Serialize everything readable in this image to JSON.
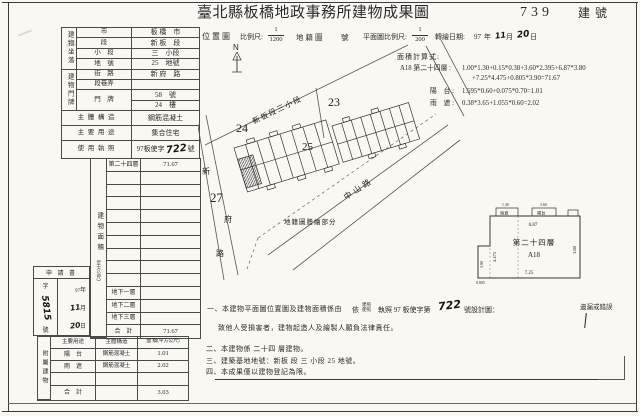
{
  "header": {
    "title": "臺北縣板橋地政事務所建物成果圖",
    "building_no": "739",
    "building_no_suffix": "建號"
  },
  "scalebar": {
    "location_label": "位置圖",
    "scale_label": "比例尺:",
    "loc_num": "1",
    "loc_den": "1200",
    "cadastre": "地籍圖",
    "sheet_suffix": "號",
    "north": "N",
    "plan_scale_label": "平面圖比例尺:",
    "plan_num": "1",
    "plan_den": "200",
    "date_label": "轉繪日期:",
    "date_year": "97",
    "year_char": "年",
    "date_month": "11",
    "month_char": "月",
    "date_day": "20",
    "day_char": "日"
  },
  "calc": {
    "title": "面積計算式:",
    "l1_label": "A18  第二十四層 :",
    "l1a": "1.00*1.30+0.15*0.38+3.60*2.395+6.87*3.80",
    "l1b": "+7.25*4.475+0.805*3.90=71.67",
    "l2_label": "陽　台 :",
    "l2": "1.595*0.60+0.075*0.70=1.01",
    "l3_label": "雨　遮 :",
    "l3": "0.38*3.65+1.055*0.60=2.02"
  },
  "site": {
    "group1_label": "建物坐落",
    "group2_label": "建物門牌",
    "rows": [
      {
        "label": "市",
        "value": "板 橋　市"
      },
      {
        "label": "段",
        "value": "新 板　段"
      },
      {
        "label": "小　段",
        "value": "三　小段"
      },
      {
        "label": "地　號",
        "value": "25　地號"
      },
      {
        "label": "街　路",
        "value": "新 府　路"
      },
      {
        "label": "段巷弄",
        "value": ""
      },
      {
        "label": "門　牌",
        "value": "58　號"
      },
      {
        "label": "",
        "value": "24　樓"
      }
    ],
    "structure_label": "主 體 構 造",
    "structure": "鋼筋混凝土",
    "use_label": "主 要 用 途",
    "use": "集合住宅",
    "license_label": "使 用 執 照",
    "license_pre": "97板使字",
    "license_hw": "722",
    "license_suf": "號"
  },
  "area": {
    "vlabel": "建物面積",
    "unit": "（平方公尺）",
    "rows": [
      {
        "floor": "第二十四層",
        "area": "71.67"
      },
      {
        "floor": "",
        "area": ""
      },
      {
        "floor": "",
        "area": ""
      },
      {
        "floor": "",
        "area": ""
      },
      {
        "floor": "",
        "area": ""
      },
      {
        "floor": "",
        "area": ""
      },
      {
        "floor": "",
        "area": ""
      },
      {
        "floor": "",
        "area": ""
      },
      {
        "floor": "",
        "area": ""
      },
      {
        "floor": "",
        "area": ""
      },
      {
        "floor": "地下一層",
        "area": ""
      },
      {
        "floor": "地下二層",
        "area": ""
      },
      {
        "floor": "地下三層",
        "area": ""
      },
      {
        "floor": "合　計",
        "area": "71.67"
      }
    ]
  },
  "annex": {
    "vlabel": "附屬建物",
    "h1": "主要用途",
    "h2": "主體構造",
    "h3": "面 積(平方公尺)",
    "rows": [
      {
        "use": "陽　台",
        "struct": "鋼筋混凝土",
        "area": "1.01"
      },
      {
        "use": "雨　遮",
        "struct": "鋼筋混凝土",
        "area": "2.02"
      },
      {
        "use": "",
        "struct": "",
        "area": ""
      }
    ],
    "total_label": "合　計",
    "total": "3.03"
  },
  "application": {
    "title": "申 請 書",
    "no_pre": "字",
    "no_hw": "5815",
    "no_suf": "號",
    "year": "97",
    "year_char": "年",
    "month": "11",
    "month_char": "月",
    "day": "20",
    "day_char": "日"
  },
  "map": {
    "section_label": "新板段三小段",
    "lot23": "23",
    "lot24": "24",
    "lot25": "25",
    "lot27": "27",
    "road_left_1": "新",
    "road_left_2": "府",
    "road_left_3": "路",
    "road_diag": "中山路",
    "note": "地籍圖謄繪部分"
  },
  "plan": {
    "floor": "第二十四層",
    "unit": "A18",
    "dim_top": "6.87",
    "dim_bottom": "7.25",
    "dim_right": "3.80",
    "dim_left_inner": "4.475",
    "dim_left": "3.90",
    "dim_bottom_left": "0.805",
    "dim_t1": "1.30",
    "dim_t2": "3.60",
    "canopy": "雨遮",
    "balcony": "陽台"
  },
  "notes": {
    "n1a": "一、本建物平面圖位置圖及建物面積係由",
    "n1b": "依",
    "lic_top": "建照",
    "lic_bot": "使照",
    "n1c": "執照 97 板使字第",
    "n1_hw": "722",
    "n1d": "號設計圖：",
    "n1e": "遺漏或錯誤",
    "n2": "致他人受損害者，建物起造人及繪製人願負法律責任。",
    "n3": "二、本建物係 二十四 層建物。",
    "n4": "三、建築基地地號：新板 段 三 小段 25 地號。",
    "n5": "四、本成果僅以建物登記為限。"
  }
}
